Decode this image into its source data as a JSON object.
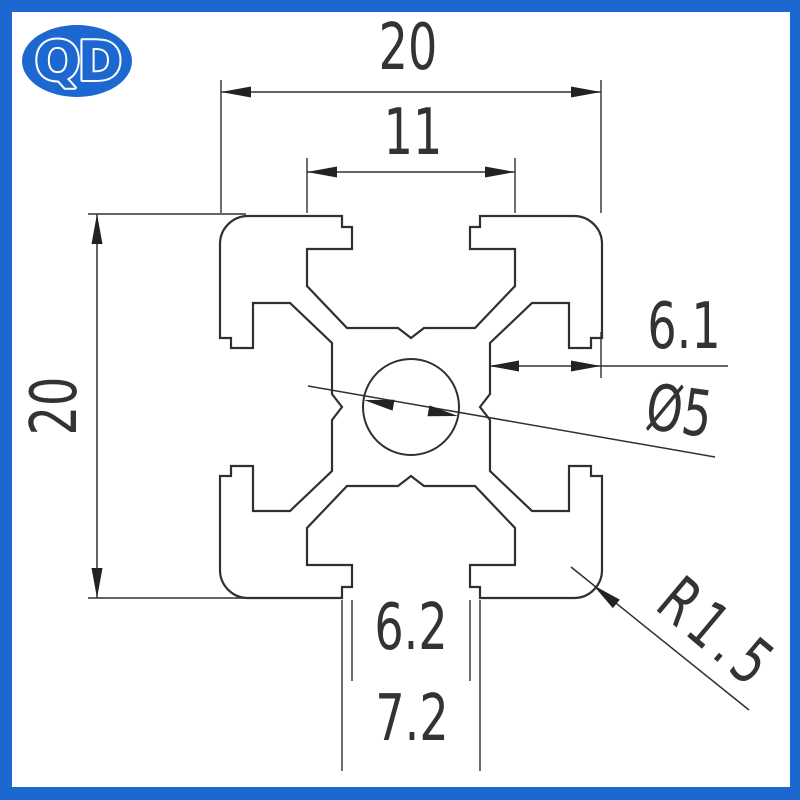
{
  "logo": {
    "text": "QD",
    "bg": "#1c67d0",
    "fg": "#ffffff"
  },
  "annotations": {
    "top_width": "20",
    "cavity_width": "11",
    "left_height": "20",
    "slot_depth": "6.1",
    "hole_diameter": "Ø5",
    "slot_opening": "6.2",
    "slot_face_width": "7.2",
    "corner_radius": "R1.5"
  },
  "drawing": {
    "stroke": "#303030",
    "outline_width": 2.2,
    "dim_width": 1.5,
    "profile": {
      "cx": 411,
      "cy": 407,
      "half": 191,
      "cornerR": 28,
      "holeR": 48,
      "slot": {
        "w1": 69,
        "w2": 59,
        "w3": 104,
        "d1": 11,
        "d2": 33,
        "d3": 70,
        "fx": 64,
        "fd": 112,
        "vw": 13,
        "vd": 122
      }
    },
    "ext_lines": [
      [
        221,
        80,
        221,
        213
      ],
      [
        601,
        80,
        601,
        213
      ],
      [
        307,
        158,
        307,
        213
      ],
      [
        515,
        158,
        515,
        213
      ],
      [
        88,
        214,
        246,
        214
      ],
      [
        88,
        598,
        246,
        598
      ],
      [
        601,
        332,
        601,
        378
      ],
      [
        352,
        600,
        352,
        681
      ],
      [
        470,
        600,
        470,
        681
      ],
      [
        342,
        600,
        342,
        771
      ],
      [
        480,
        600,
        480,
        771
      ]
    ],
    "dim_lines": [
      [
        221,
        92,
        601,
        92
      ],
      [
        307,
        172,
        515,
        172
      ],
      [
        97,
        214,
        97,
        598
      ],
      [
        489,
        366,
        728,
        366
      ],
      [
        308,
        386,
        715,
        457
      ],
      [
        571,
        567,
        749,
        710
      ]
    ],
    "arrows": [
      [
        221,
        92,
        180
      ],
      [
        601,
        92,
        0
      ],
      [
        307,
        172,
        180
      ],
      [
        515,
        172,
        0
      ],
      [
        97,
        214,
        -90
      ],
      [
        97,
        598,
        90
      ],
      [
        489,
        366,
        180
      ],
      [
        601,
        366,
        0
      ],
      [
        364,
        400,
        190
      ],
      [
        458,
        416,
        10
      ],
      [
        593,
        585,
        219
      ]
    ]
  }
}
